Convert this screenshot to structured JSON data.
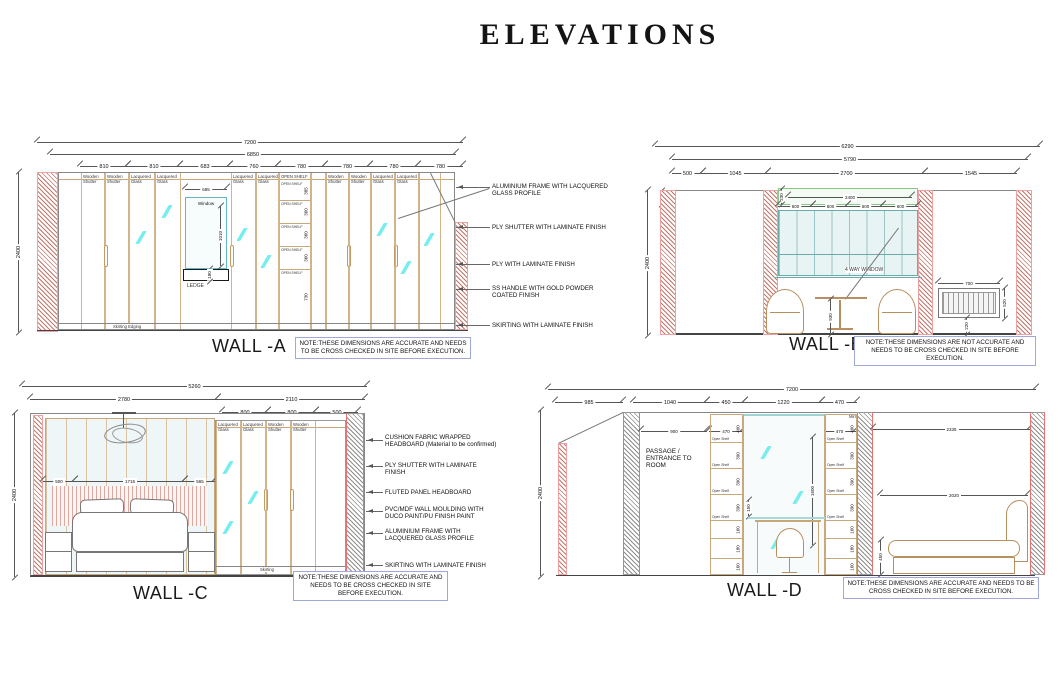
{
  "title": "ELEVATIONS",
  "wall_a": {
    "name": "WALL -A",
    "note": "NOTE:THESE DIMENSIONS ARE ACCURATE AND NEEDS TO BE CROSS CHECKED IN SITE BEFORE EXECUTION.",
    "dim_total": "7200",
    "dim_inner": "6850",
    "dim_height": "2400",
    "segments": [
      "810",
      "810",
      "683",
      "760",
      "780",
      "780",
      "780",
      "780"
    ],
    "panels": [
      "Wooden Shutter",
      "Wooden Shutter",
      "Lacquered Glass",
      "Lacquered Glass",
      "Lacquered Glass",
      "Lacquered Glass",
      "OPEN SHELF",
      "Wooden Shutter",
      "Wooden Shutter",
      "Lacquered Glass",
      "Lacquered Glass"
    ],
    "window": {
      "label": "Window",
      "width": "685",
      "height": "1010"
    },
    "ledge": {
      "label": "LEDGE",
      "height": "180"
    },
    "open_shelf": "OPEN SHELF",
    "shelf_heights": [
      "385",
      "360",
      "360",
      "360",
      "730"
    ],
    "skirting": "Skirting Edging",
    "annotations": [
      "ALUMINIUM FRAME WITH LACQUERED GLASS PROFILE",
      "PLY SHUTTER WITH LAMINATE FINISH",
      "PLY WITH LAMINATE FINISH",
      "SS HANDLE WITH GOLD POWDER COATED FINISH",
      "SKIRTING WITH LAMINATE FINISH"
    ]
  },
  "wall_b": {
    "name": "WALL -B",
    "note": "NOTE:THESE DIMENSIONS ARE NOT ACCURATE AND NEEDS TO BE CROSS CHECKED IN SITE BEFORE EXECUTION.",
    "dim_total": "6290",
    "dim_inner": "5790",
    "dim_height": "2400",
    "wall_depth": "220",
    "segments": [
      "500",
      "1045",
      "2700",
      "1545"
    ],
    "pelmet_height": "230",
    "window_width": "2400",
    "pane_dims": [
      "600",
      "600",
      "600",
      "600"
    ],
    "window_label": "4 WAY WINDOW",
    "table_height": "930",
    "radiator": {
      "width": "700",
      "height": "520",
      "offset": "220"
    }
  },
  "wall_c": {
    "name": "WALL -C",
    "note": "NOTE:THESE DIMENSIONS ARE ACCURATE AND NEEDS TO BE CROSS CHECKED IN SITE BEFORE EXECUTION.",
    "dim_total": "5260",
    "dim_left": "2780",
    "dim_right": "2110",
    "dim_height": "2400",
    "segments": [
      "800",
      "800",
      "500"
    ],
    "inner_dims": [
      "500",
      "1715",
      "565"
    ],
    "panels": [
      "Lacquered Glass",
      "Lacquered Glass",
      "Wooden Shutter",
      "Wooden Shutter"
    ],
    "skirting": "Skirting",
    "annotations": [
      "CUSHION FABRIC WRAPPED HEADBOARD (Material to be confirmed)",
      "PLY SHUTTER WITH LAMINATE FINISH",
      "FLUTED PANEL HEADBOARD",
      "PVC/MDF WALL MOULDING WITH DUCO PAINT/PU FINISH PAINT",
      "ALUMINIUM FRAME WITH LACQUERED GLASS PROFILE",
      "SKIRTING WITH LAMINATE FINISH"
    ]
  },
  "wall_d": {
    "name": "WALL -D",
    "note": "NOTE:THESE DIMENSIONS ARE ACCURATE AND NEEDS TO BE CROSS CHECKED IN SITE BEFORE EXECUTION.",
    "dim_total": "7200",
    "dim_height": "2400",
    "segments": [
      "985",
      "1040",
      "450",
      "1220",
      "470"
    ],
    "inner_dims": [
      "900",
      "470",
      "1200",
      "470"
    ],
    "right_dims": [
      "2335",
      "2020"
    ],
    "mirror_height": "1600",
    "bed_height": "450",
    "desk_dim": "150",
    "passage_label": "PASSAGE /\nENTRANCE TO\nROOM",
    "mirror_label": "Mirror",
    "open_shelf": "Open Shelf",
    "shelf_heights": [
      "400",
      "390",
      "390",
      "390"
    ],
    "drawer_heights": [
      "160",
      "180",
      "160"
    ]
  }
}
